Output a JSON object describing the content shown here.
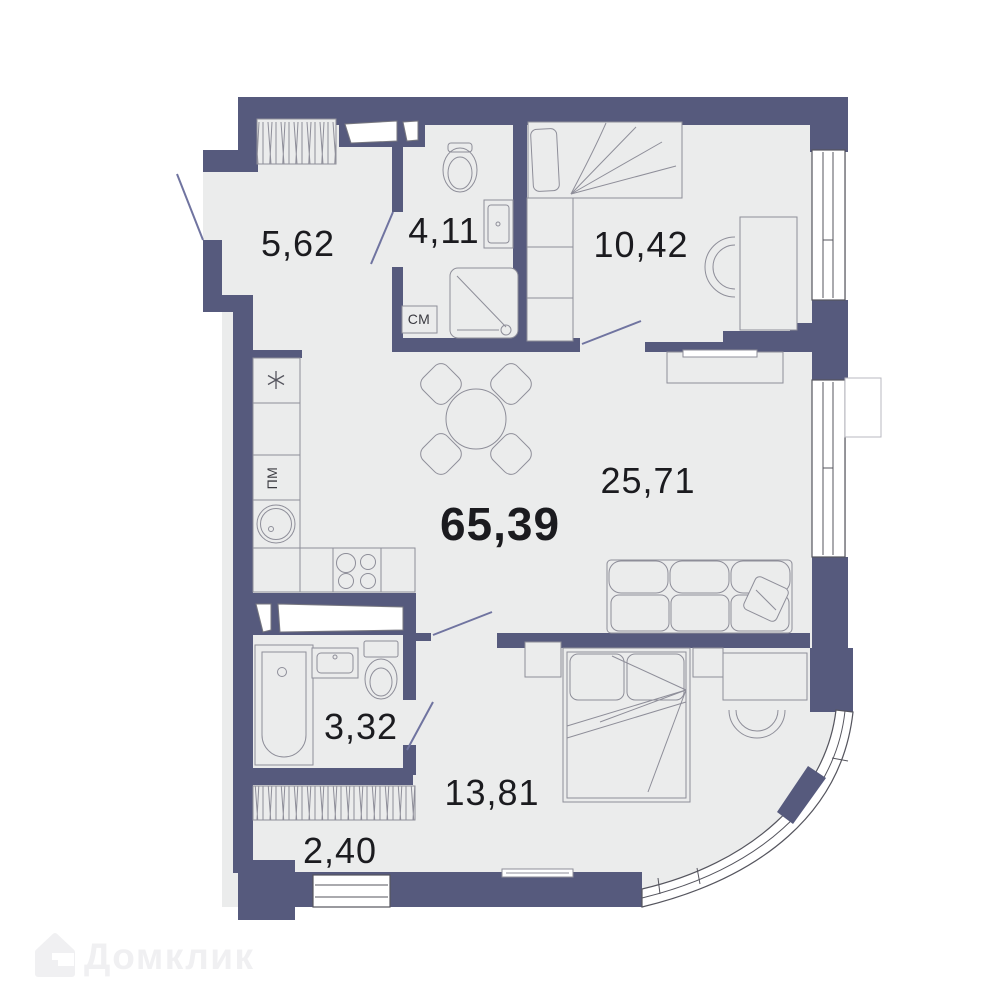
{
  "plan": {
    "labels": {
      "total": "65,39",
      "hallway": "5,62",
      "bathroom_top": "4,11",
      "bedroom_top": "10,42",
      "living": "25,71",
      "bathroom_bottom": "3,32",
      "bedroom_bottom": "13,81",
      "wardrobe": "2,40"
    },
    "appliances": {
      "washing_machine": "СМ",
      "dishwasher": "ПМ"
    }
  },
  "watermark": {
    "brand": "Домклик"
  },
  "colors": {
    "wall": "#565a7d",
    "floor": "#ebecec",
    "furniture_line": "#8e8e99",
    "label": "#1b1b1f",
    "door": "#7074a0",
    "watermark": "#f0f0f2"
  }
}
